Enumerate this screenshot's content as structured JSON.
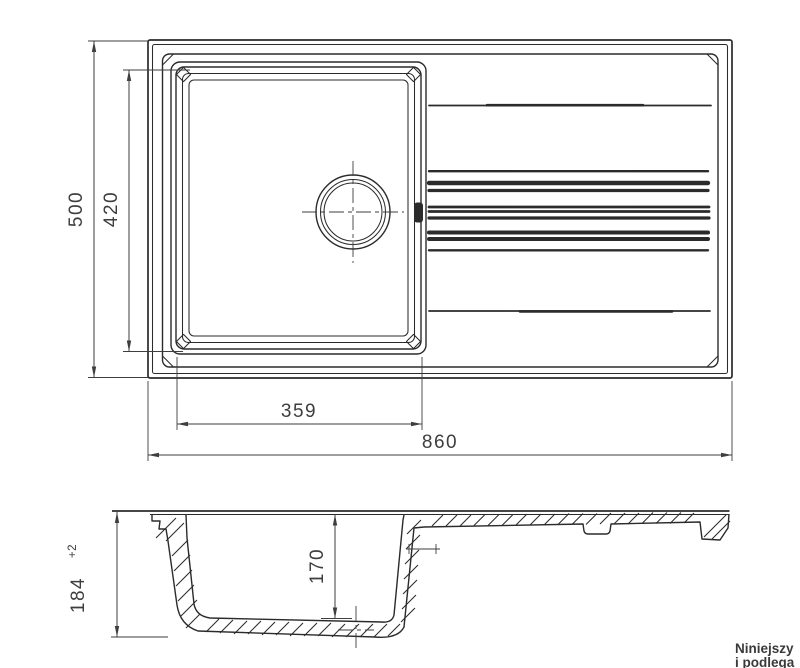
{
  "colors": {
    "background": "#ffffff",
    "line": "#2b2b2b",
    "dim": "#3e3e3e",
    "note": "#3a3a3a"
  },
  "drawing": {
    "type": "kitchen sink technical drawing, plan view and cross-section",
    "plan_view": {
      "dims": {
        "overall_width": {
          "value": "860"
        },
        "overall_depth": {
          "value": "500"
        },
        "bowl_inner_length": {
          "value": "420"
        },
        "bowl_inner_width": {
          "value": "359"
        }
      }
    },
    "section_view": {
      "dims": {
        "overall_height": {
          "value": "184",
          "tolerance": "+2"
        },
        "bowl_depth": {
          "value": "170"
        }
      }
    },
    "note": {
      "line1": "Niniejszy",
      "line2": "i podlega"
    }
  }
}
